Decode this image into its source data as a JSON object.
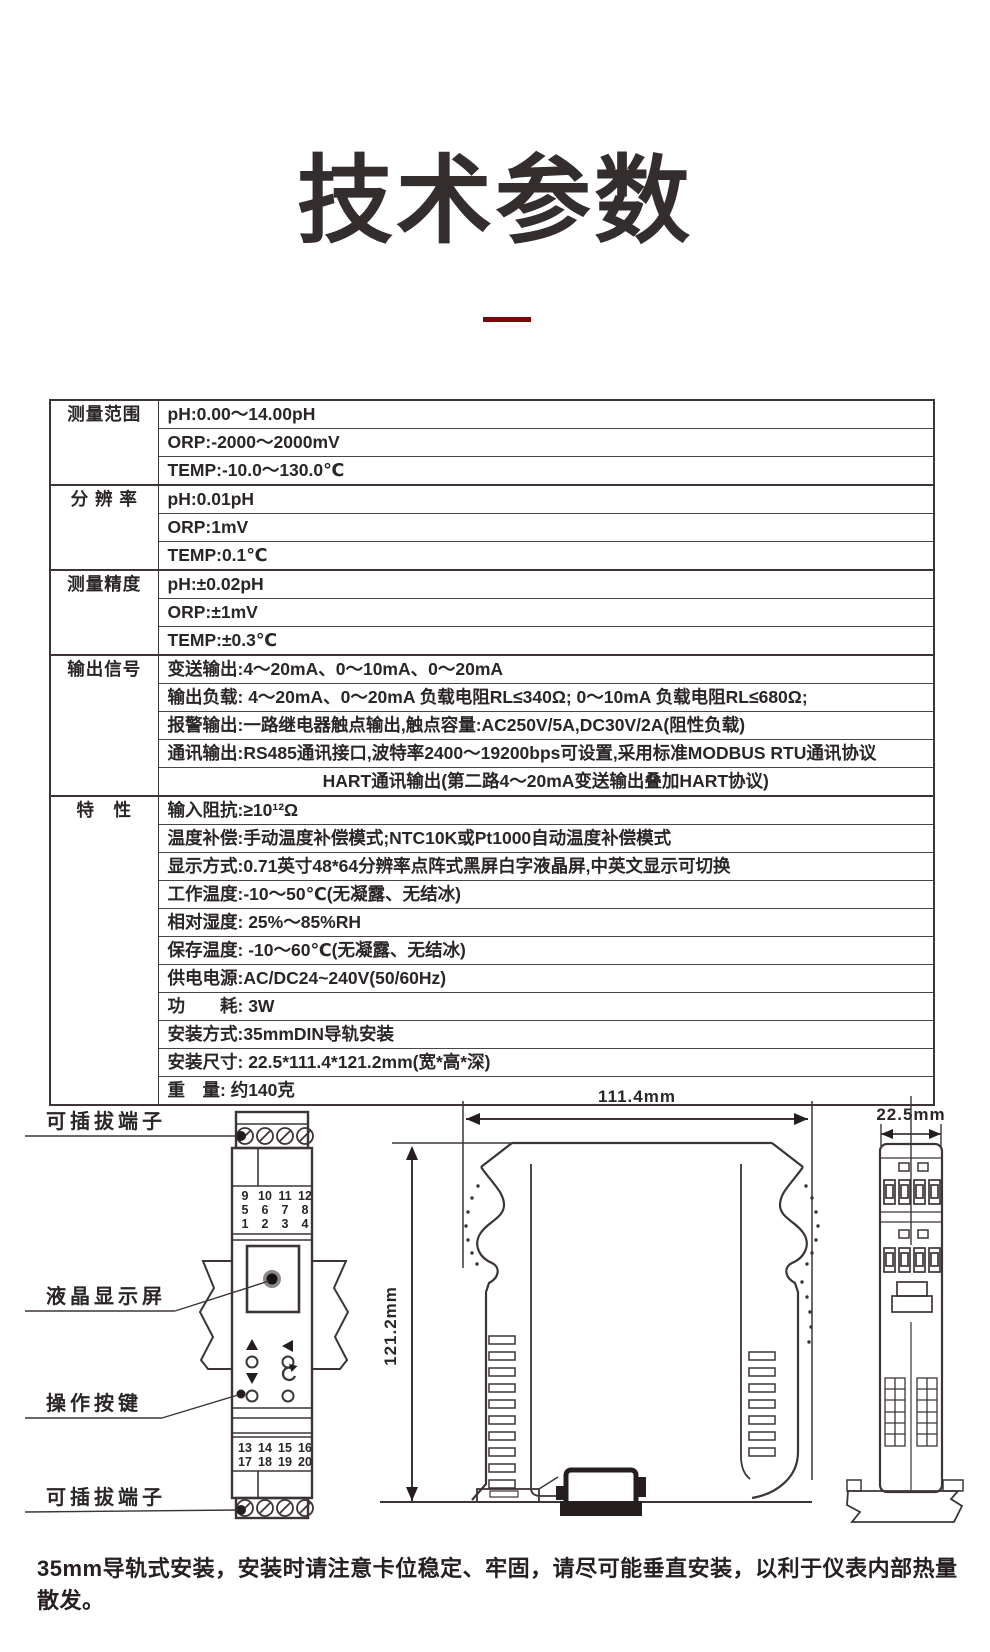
{
  "page": {
    "title": "技术参数",
    "caption": "35mm导轨式安装，安装时请注意卡位稳定、牢固，请尽可能垂直安装，以利于仪表内部热量散发。"
  },
  "colors": {
    "ink": "#332d2d",
    "line": "#3d3535",
    "accent_underline": "#7a0a0a",
    "terminal_highlight": "#e23b26"
  },
  "spec_table": {
    "groups": [
      {
        "label": "测量范围",
        "rows": [
          "pH:0.00～14.00pH",
          "ORP:-2000～2000mV",
          "TEMP:-10.0～130.0℃"
        ]
      },
      {
        "label": "分 辨 率",
        "rows": [
          "pH:0.01pH",
          "ORP:1mV",
          "TEMP:0.1℃"
        ]
      },
      {
        "label": "测量精度",
        "rows": [
          "pH:±0.02pH",
          "ORP:±1mV",
          "TEMP:±0.3℃"
        ]
      },
      {
        "label": "输出信号",
        "rows": [
          "变送输出:4～20mA、0～10mA、0～20mA",
          "输出负载: 4～20mA、0～20mA 负载电阻RL≤340Ω; 0～10mA 负载电阻RL≤680Ω;",
          "报警输出:一路继电器触点输出,触点容量:AC250V/5A,DC30V/2A(阻性负载)",
          "通讯输出:RS485通讯接口,波特率2400～19200bps可设置,采用标准MODBUS RTU通讯协议",
          "HART通讯输出(第二路4～20mA变送输出叠加HART协议)"
        ]
      },
      {
        "label": "特　性",
        "rows": [
          "输入阻抗:≥10¹²Ω",
          "温度补偿:手动温度补偿模式;NTC10K或Pt1000自动温度补偿模式",
          "显示方式:0.71英寸48*64分辨率点阵式黑屏白字液晶屏,中英文显示可切换",
          "工作温度:-10～50℃(无凝露、无结冰)",
          "相对湿度: 25%～85%RH",
          "保存温度: -10～60℃(无凝露、无结冰)",
          "供电电源:AC/DC24~240V(50/60Hz)",
          "功　　耗: 3W",
          "安装方式:35mmDIN导轨安装",
          "安装尺寸: 22.5*111.4*121.2mm(宽*高*深)",
          "重　量: 约140克"
        ]
      }
    ]
  },
  "front_view": {
    "labels": {
      "terminal_top": "可插拔端子",
      "lcd": "液晶显示屏",
      "keys": "操作按键",
      "terminal_bottom": "可插拔端子"
    },
    "terminals_top": [
      [
        "9",
        "10",
        "11",
        "12"
      ],
      [
        "5",
        "6",
        "7",
        "8"
      ],
      [
        "1",
        "2",
        "3",
        "4"
      ]
    ],
    "terminals_bottom": [
      [
        "13",
        "14",
        "15",
        "16"
      ],
      [
        "17",
        "18",
        "19",
        "20"
      ]
    ]
  },
  "dimensions": {
    "length": "111.4mm",
    "depth": "121.2mm",
    "width": "22.5mm"
  }
}
